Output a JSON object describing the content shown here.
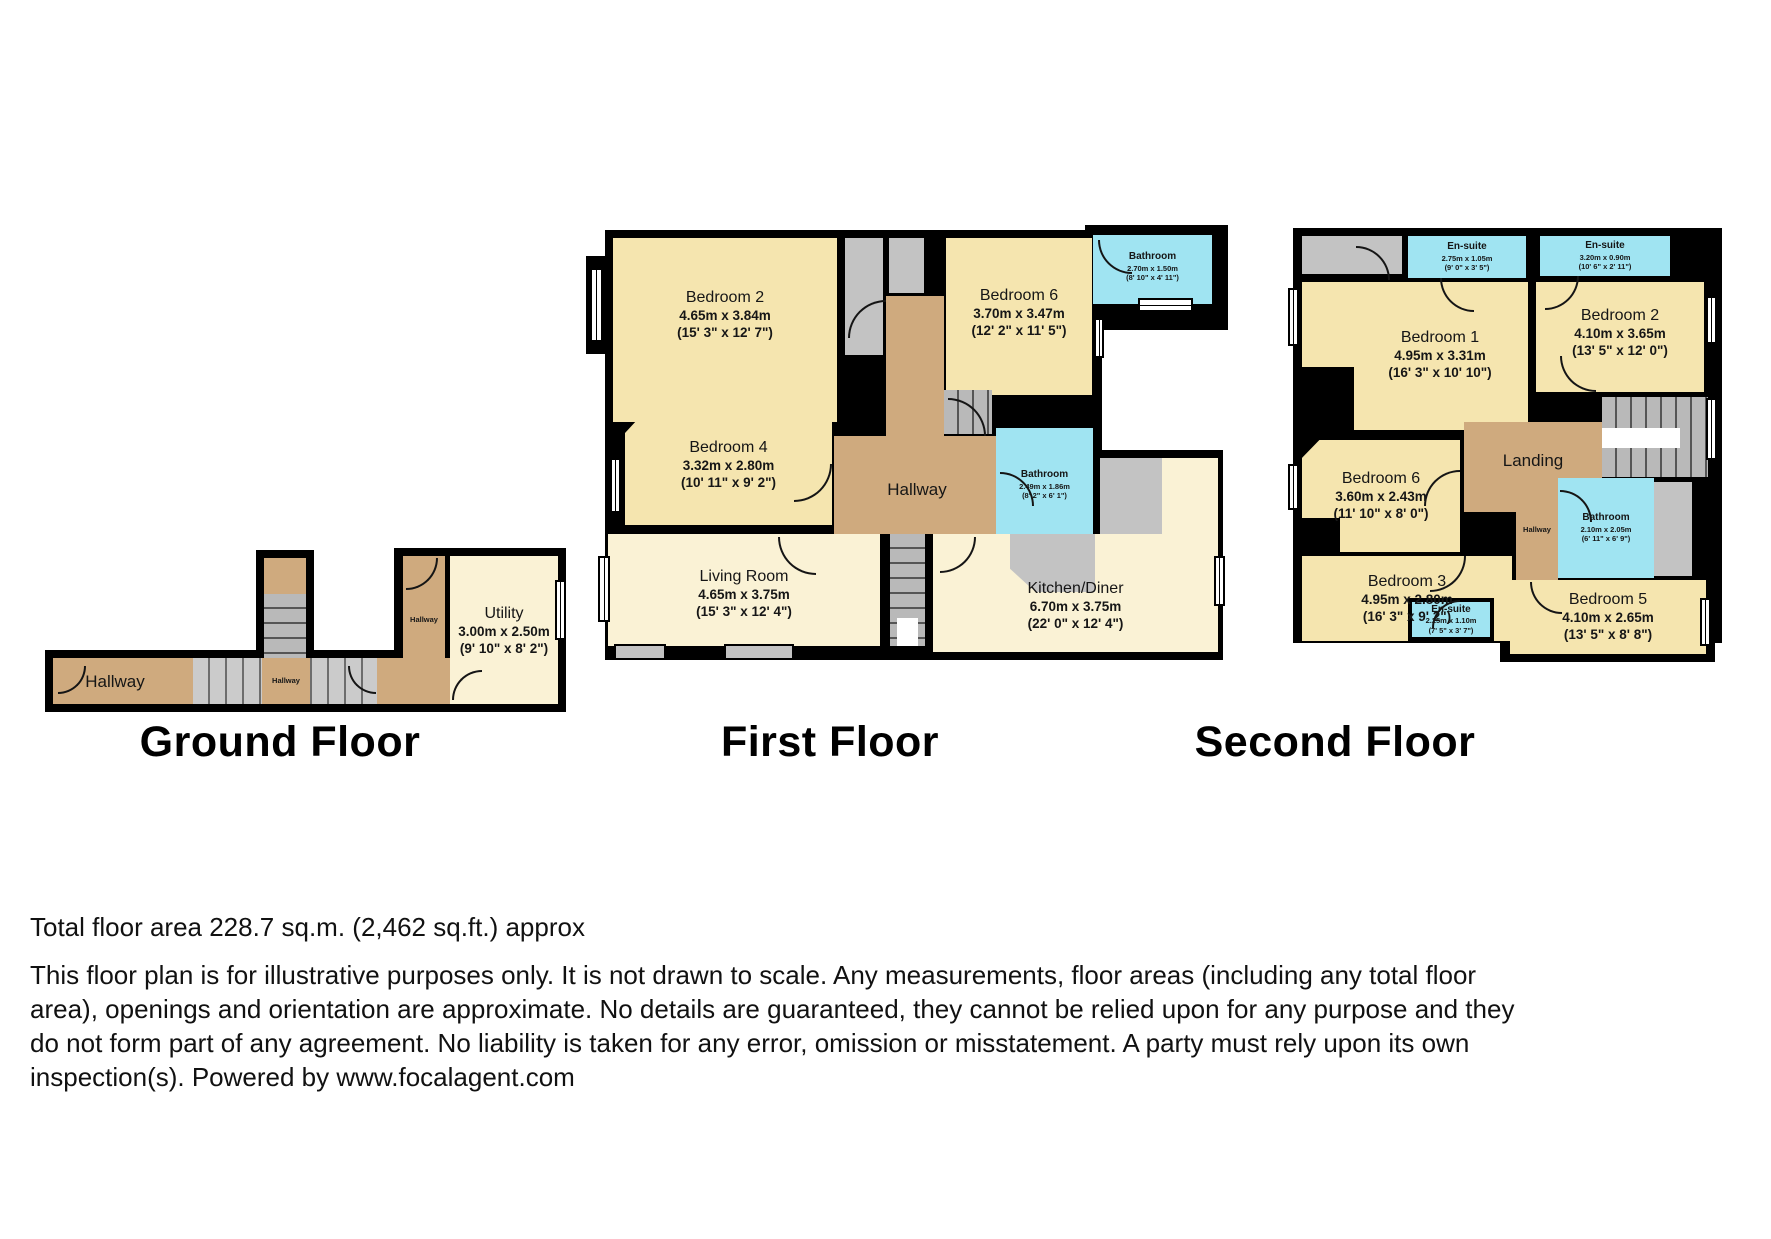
{
  "floors": [
    {
      "title": "Ground Floor",
      "rooms": {
        "hallway_main": {
          "name": "Hallway"
        },
        "hallway_mid": {
          "name": "Hallway"
        },
        "hallway_side": {
          "name": "Hallway"
        },
        "utility": {
          "name": "Utility",
          "dim_m": "3.00m x 2.50m",
          "dim_ft": "(9' 10\" x 8' 2\")"
        }
      }
    },
    {
      "title": "First Floor",
      "rooms": {
        "bedroom2": {
          "name": "Bedroom 2",
          "dim_m": "4.65m x 3.84m",
          "dim_ft": "(15' 3\" x 12' 7\")"
        },
        "bedroom6": {
          "name": "Bedroom 6",
          "dim_m": "3.70m x 3.47m",
          "dim_ft": "(12' 2\" x 11' 5\")"
        },
        "bathroom_top": {
          "name": "Bathroom",
          "dim_m": "2.70m x 1.50m",
          "dim_ft": "(8' 10\" x 4' 11\")"
        },
        "bedroom4": {
          "name": "Bedroom 4",
          "dim_m": "3.32m x 2.80m",
          "dim_ft": "(10' 11\" x 9' 2\")"
        },
        "hallway": {
          "name": "Hallway"
        },
        "bathroom_mid": {
          "name": "Bathroom",
          "dim_m": "2.49m x 1.86m",
          "dim_ft": "(8' 2\" x 6' 1\")"
        },
        "living": {
          "name": "Living Room",
          "dim_m": "4.65m x 3.75m",
          "dim_ft": "(15' 3\" x 12' 4\")"
        },
        "kitchen": {
          "name": "Kitchen/Diner",
          "dim_m": "6.70m x 3.75m",
          "dim_ft": "(22' 0\" x 12' 4\")"
        }
      }
    },
    {
      "title": "Second Floor",
      "rooms": {
        "ensuite1": {
          "name": "En-suite",
          "dim_m": "2.75m x 1.05m",
          "dim_ft": "(9' 0\" x 3' 5\")"
        },
        "ensuite2": {
          "name": "En-suite",
          "dim_m": "3.20m x 0.90m",
          "dim_ft": "(10' 6\" x 2' 11\")"
        },
        "bedroom1": {
          "name": "Bedroom 1",
          "dim_m": "4.95m x 3.31m",
          "dim_ft": "(16' 3\" x 10' 10\")"
        },
        "bedroom2": {
          "name": "Bedroom 2",
          "dim_m": "4.10m x 3.65m",
          "dim_ft": "(13' 5\" x 12' 0\")"
        },
        "landing": {
          "name": "Landing"
        },
        "bedroom6": {
          "name": "Bedroom 6",
          "dim_m": "3.60m x 2.43m",
          "dim_ft": "(11' 10\" x 8' 0\")"
        },
        "hallway": {
          "name": "Hallway"
        },
        "bathroom": {
          "name": "Bathroom",
          "dim_m": "2.10m x 2.05m",
          "dim_ft": "(6' 11\" x 6' 9\")"
        },
        "bedroom3": {
          "name": "Bedroom 3",
          "dim_m": "4.95m x 2.80m",
          "dim_ft": "(16' 3\" x 9' 2\")"
        },
        "ensuite3": {
          "name": "En-suite",
          "dim_m": "2.25m x 1.10m",
          "dim_ft": "(7' 5\" x 3' 7\")"
        },
        "bedroom5": {
          "name": "Bedroom 5",
          "dim_m": "4.10m x 2.65m",
          "dim_ft": "(13' 5\" x 8' 8\")"
        }
      }
    }
  ],
  "footer": {
    "total_area": "Total floor area 228.7 sq.m. (2,462 sq.ft.) approx",
    "disclaimer": "This floor plan is for illustrative purposes only. It is not drawn to scale. Any measurements, floor areas (including any total floor area), openings and orientation are approximate. No details are guaranteed, they cannot be relied upon for any purpose and they do not form part of any agreement. No liability is taken for any error, omission or misstatement. A party must rely upon its own inspection(s). Powered by www.focalagent.com"
  },
  "colors": {
    "wall": "#000000",
    "bedroom_fill": "#F5E5AF",
    "living_fill": "#FAF2D5",
    "hallway_fill": "#CFAA7E",
    "bathroom_fill": "#A0E4F2",
    "closet_fill": "#C3C3C3"
  }
}
